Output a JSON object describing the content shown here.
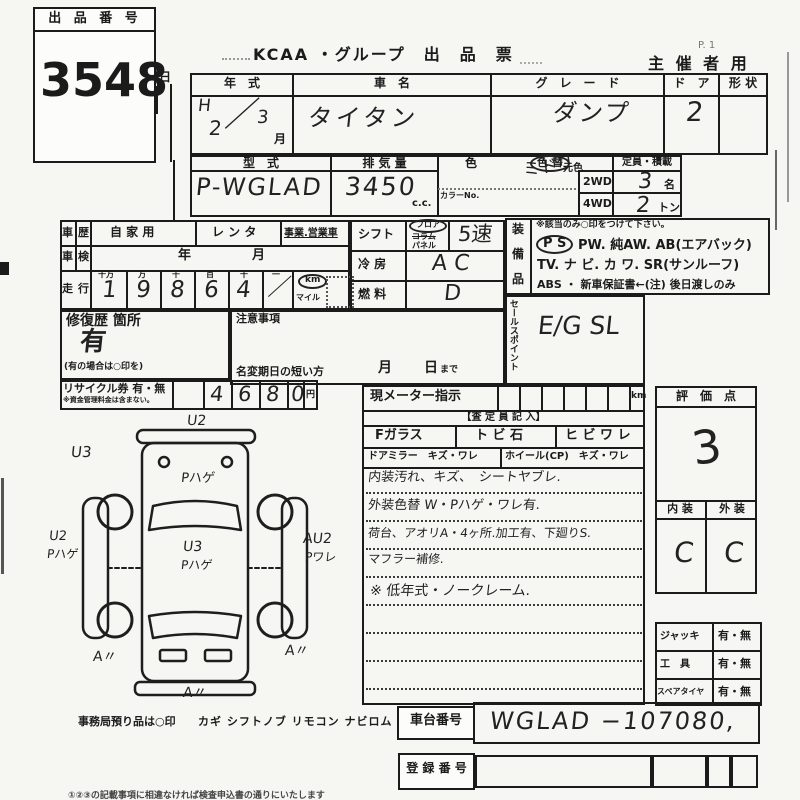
{
  "exhibit": {
    "label": "出 品 番 号",
    "number": "3548"
  },
  "header": {
    "title": "KCAA ・グループ　出　品　票",
    "page": "P.  1",
    "organizer": "主 催 者 用"
  },
  "t1": {
    "year_h": "年　式",
    "name_h": "車　名",
    "grade_h": "グ　レ　ー　ド",
    "door_h": "ド　ア",
    "shape_h": "形 状",
    "year_a": "H",
    "year_b": "2",
    "year_slash": "／",
    "year_c": "3",
    "month_unit": "月",
    "name_v": "タイタン",
    "grade_v": "ダンプ",
    "door_v": "2"
  },
  "t2": {
    "model_h": "型　式",
    "disp_h": "排 気 量",
    "color_h": "色",
    "colorchg_h": "色 替",
    "genshoku": "元色",
    "colorno": "カラーNo.",
    "capacity_h": "定員・積載",
    "model_v": "P-WGLAD",
    "disp_v": "3450",
    "cc": "c.c.",
    "color_v": "ミドリ",
    "wd2": "2WD",
    "wd2_v": "3",
    "wd2_u": "名",
    "wd4": "4WD",
    "wd4_v": "2",
    "wd4_u": "トン"
  },
  "hist": {
    "shareki_a": "車",
    "shareki_b": "歴",
    "shaken_a": "車",
    "shaken_b": "検",
    "soukou_a": "走",
    "soukou_b": "行",
    "private": "自 家 用",
    "rental": "レ ン タ",
    "business": "事業.営業車",
    "year": "年",
    "month": "月",
    "d_labels": [
      "十万",
      "万",
      "千",
      "百",
      "十",
      "一"
    ],
    "digits": [
      "1",
      "9",
      "8",
      "6",
      "4",
      "／"
    ],
    "km": "km",
    "mile": "マイル"
  },
  "drive": {
    "shift_h": "シフト",
    "floor": "フロア",
    "column": "コラム",
    "panel": "パネル",
    "shift_v": "5速",
    "ac_h": "冷 房",
    "ac_v": "A C",
    "fuel_h": "燃 料",
    "fuel_v": "D"
  },
  "equip": {
    "s1": "装",
    "s2": "備",
    "s3": "品",
    "note": "※該当のみ○印をつけて下さい。",
    "ps": "P S",
    "l1": "PW.  純AW.  AB(エアバック)",
    "l2": "TV.  ナ ビ.  カ ワ.  SR(サンルーフ)",
    "l3": "ABS ・ 新車保証書←(注) 後日渡しのみ"
  },
  "sales": {
    "side": "セールスポイント",
    "value": "E/G  SL"
  },
  "repair": {
    "label": "修復歴 箇所",
    "value": "有",
    "note": "(有の場合は○印を)"
  },
  "caution": {
    "label": "注意事項",
    "namechange": "名変期日の短い方",
    "month": "月",
    "day": "日",
    "made": "まで"
  },
  "recycle": {
    "label": "リサイクル券 有・無",
    "note": "※資金管理料金は含まない。",
    "digits": [
      "4",
      "6",
      "8",
      "0"
    ],
    "yen": "円"
  },
  "meter": {
    "label": "現メーター指示",
    "unit": "km",
    "staff": "【査 定 員 記 入】",
    "c1": "Fガラス",
    "c2": "ト ビ 石",
    "c3": "ヒ ビ ワ レ",
    "c4": "ドアミラー　キズ・ワレ",
    "c5": "ホイール(CP)　キズ・ワレ",
    "n1": "内装汚れ、キズ、　シートヤブレ.",
    "n2": "外装色替 W・Pハゲ・ワレ有.",
    "n3": "荷台、アオリA・4ヶ所.加工有、下廻りS.",
    "n4": "マフラー補修.",
    "n5": "※ 低年式・ノークレーム."
  },
  "eval": {
    "label": "評　価　点",
    "score": "3",
    "int_h": "内 装",
    "ext_h": "外 装",
    "int_v": "C",
    "ext_v": "C"
  },
  "acc": {
    "r1l": "ジャッキ",
    "r1v": "有・無",
    "r2l": "工　具",
    "r2v": "有・無",
    "r3l": "スペアタイヤ",
    "r3v": "有・無"
  },
  "chassis": {
    "label": "車台番号",
    "value": "WGLAD −107080,"
  },
  "reg": {
    "label": "登 録 番 号"
  },
  "office": {
    "note": "事務局預り品は○印",
    "items": "カギ シフトノブ リモコン ナビロム"
  },
  "bottom": {
    "note": "①②③の記載事項に相違なければ検査申込書の通りにいたします"
  },
  "artifact": {
    "hi": "日"
  },
  "diagram": {
    "labels": [
      "U2",
      "U3",
      "Pハゲ",
      "U2",
      "Pハゲ",
      "U3",
      "Pハゲ",
      "AU2",
      "Pワレ",
      "A〃",
      "A〃",
      "A〃"
    ]
  }
}
